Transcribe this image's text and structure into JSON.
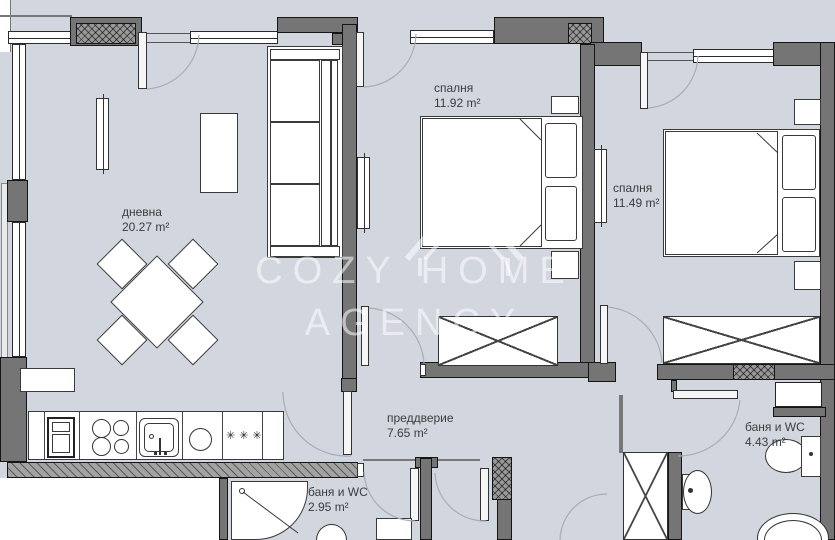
{
  "watermark": {
    "line1": "COZY HOME",
    "line2": "AGENCY"
  },
  "rooms": {
    "living": {
      "name": "дневна",
      "area": "20.27 m²"
    },
    "bedroom1": {
      "name": "спалня",
      "area": "11.92 m²"
    },
    "bedroom2": {
      "name": "спалня",
      "area": "11.49 m²"
    },
    "hallway": {
      "name": "преддверие",
      "area": "7.65 m²"
    },
    "bath1": {
      "name": "баня и WC",
      "area": "2.95 m²"
    },
    "bath2": {
      "name": "баня и WC",
      "area": "4.43 m²"
    }
  },
  "kitchen": {
    "freezer_stars": "✳✳✳"
  },
  "colors": {
    "floor": "#d2d6df",
    "wall": "#757575",
    "outline": "#151515",
    "furniture": "#ffffff",
    "watermark": "rgba(255,255,255,0.55)"
  }
}
